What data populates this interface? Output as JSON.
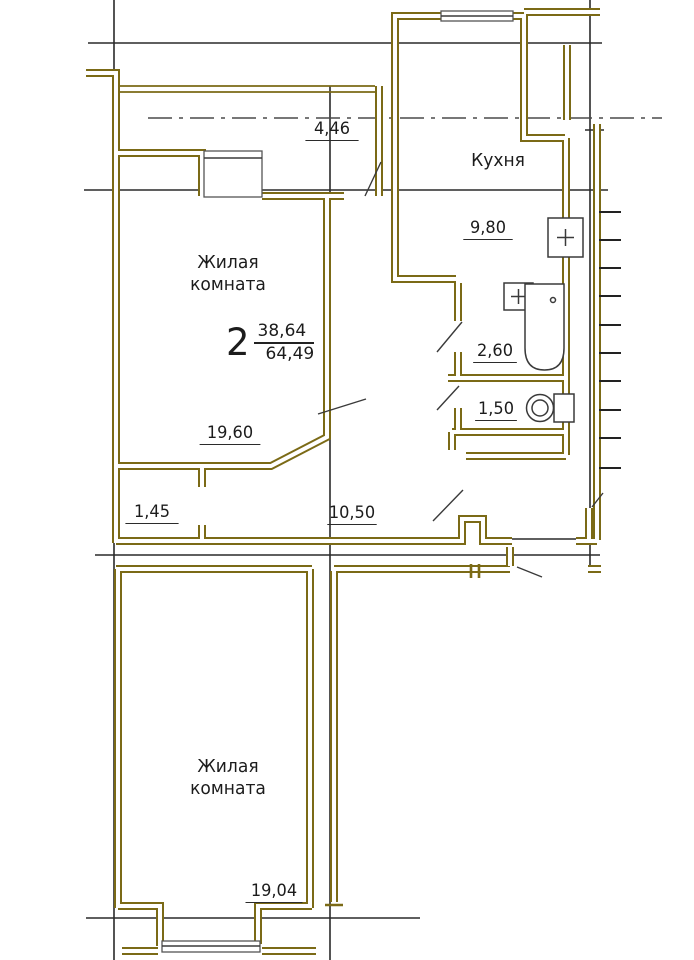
{
  "plan": {
    "apartment": {
      "number": "2",
      "living_area": "38,64",
      "total_area": "64,49"
    },
    "rooms": {
      "living_top": {
        "name": "Жилая комната",
        "area": "19,60"
      },
      "living_bottom": {
        "name": "Жилая комната",
        "area": "19,04"
      },
      "kitchen": {
        "name": "Кухня",
        "area": "9,80"
      },
      "bathroom": {
        "area": "2,60"
      },
      "wc": {
        "area": "1,50"
      },
      "hallway": {
        "area": "10,50"
      },
      "entry": {
        "area": "1,45"
      },
      "loggia": {
        "area": "4,46"
      }
    },
    "fixtures": [
      "bathtub",
      "sink",
      "toilet",
      "stove"
    ],
    "colors": {
      "wall": "#7b6a16",
      "lines": "#2a2a2a",
      "text": "#1c1c1c",
      "background": "#ffffff"
    }
  }
}
